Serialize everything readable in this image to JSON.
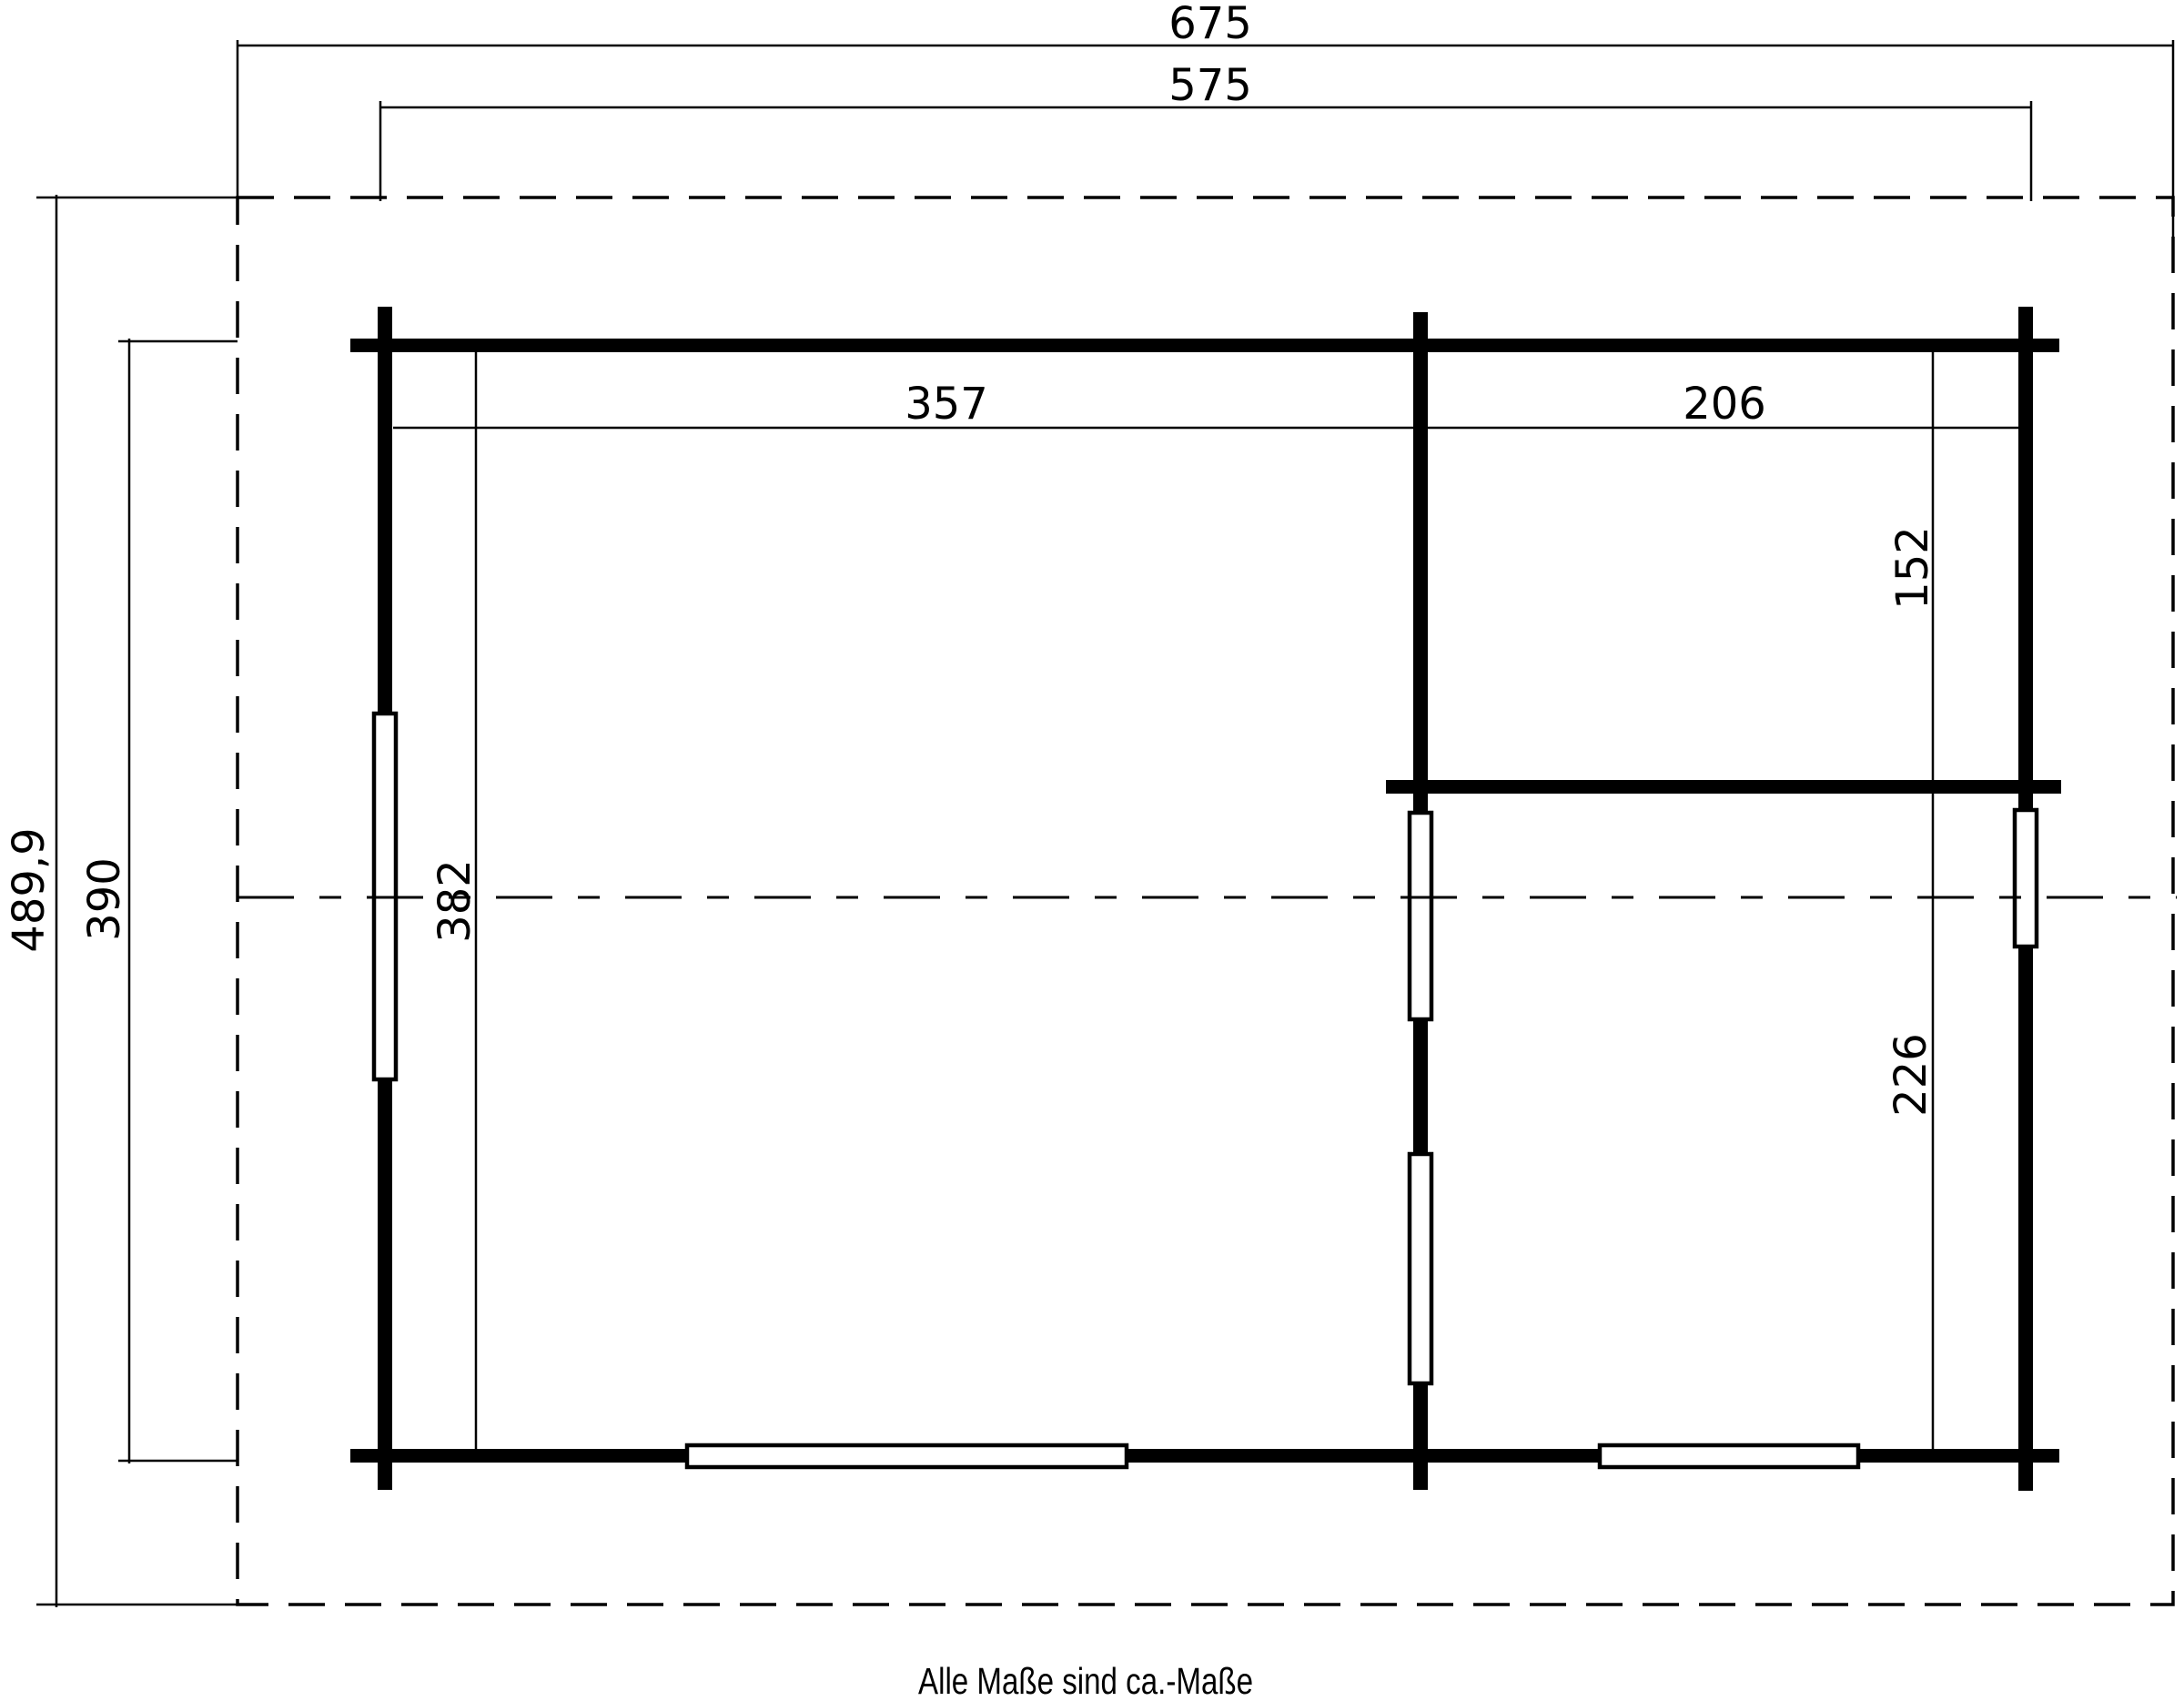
{
  "drawing": {
    "type": "floor-plan",
    "footer_note": "Alle Maße sind ca.-Maße",
    "colors": {
      "line": "#000000",
      "background": "#ffffff"
    },
    "dimensions_cm": {
      "roof_overall_width": "675",
      "body_overall_width": "575",
      "roof_overall_depth": "489,9",
      "body_overall_depth": "390",
      "main_room_width": "357",
      "right_rooms_width": "206",
      "upper_right_room_depth": "152",
      "lower_right_room_depth": "226",
      "main_room_depth": "382"
    }
  }
}
